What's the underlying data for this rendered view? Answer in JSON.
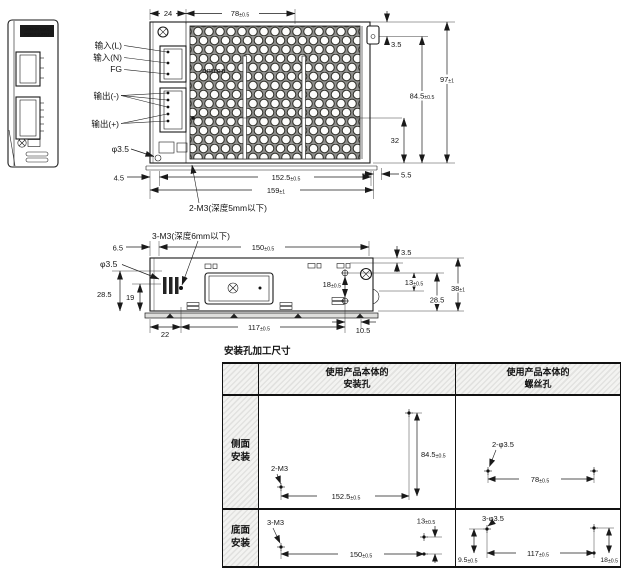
{
  "side_view": {
    "label_line1": "OMRON S8FS",
    "label_line2": "POWER SUPPLY"
  },
  "top_view": {
    "labels": {
      "input_l": "输入(L)",
      "input_n": "输入(N)",
      "fg": "FG",
      "output_minus": "输出(-)",
      "output_plus": "输出(+)",
      "emboss": "omron",
      "phi_hole": "φ3.5"
    },
    "callout_m3": "2-M3(深度5mm以下)",
    "dims": {
      "d24": {
        "v": "24",
        "tol": ""
      },
      "d78": {
        "v": "78",
        "tol": "±0.5"
      },
      "d35_top": {
        "v": "3.5",
        "tol": ""
      },
      "d97": {
        "v": "97",
        "tol": "±1"
      },
      "d845": {
        "v": "84.5",
        "tol": "±0.5"
      },
      "d32": {
        "v": "32",
        "tol": ""
      },
      "d45": {
        "v": "4.5",
        "tol": ""
      },
      "d1525": {
        "v": "152.5",
        "tol": "±0.5"
      },
      "d159": {
        "v": "159",
        "tol": "±1"
      },
      "d55": {
        "v": "5.5",
        "tol": ""
      }
    }
  },
  "bottom_view": {
    "callout_m3": "3-M3(深度6mm以下)",
    "labels": {
      "phi_hole": "φ3.5"
    },
    "dims": {
      "d65": {
        "v": "6.5",
        "tol": ""
      },
      "d150": {
        "v": "150",
        "tol": "±0.5"
      },
      "d35_right": {
        "v": "3.5",
        "tol": ""
      },
      "d13": {
        "v": "13",
        "tol": "±0.5"
      },
      "d38": {
        "v": "38",
        "tol": "±1"
      },
      "d285_right": {
        "v": "28.5",
        "tol": ""
      },
      "d18": {
        "v": "18",
        "tol": "±0.5"
      },
      "d285_left": {
        "v": "28.5",
        "tol": ""
      },
      "d19": {
        "v": "19",
        "tol": ""
      },
      "d22": {
        "v": "22",
        "tol": ""
      },
      "d117": {
        "v": "117",
        "tol": "±0.5"
      },
      "d105": {
        "v": "10.5",
        "tol": ""
      }
    }
  },
  "table": {
    "title": "安装孔加工尺寸",
    "col_mount": "使用产品本体的\n安装孔",
    "col_screw": "使用产品本体的\n螺丝孔",
    "row_side": "侧面\n安装",
    "row_bottom": "底面\n安装",
    "side_mount": {
      "label": "2-M3",
      "h": {
        "v": "152.5",
        "tol": "±0.5"
      },
      "vd": {
        "v": "84.5",
        "tol": "±0.5"
      }
    },
    "side_screw": {
      "label": "2-φ3.5",
      "h": {
        "v": "78",
        "tol": "±0.5"
      }
    },
    "bottom_mount": {
      "label": "3-M3",
      "h": {
        "v": "150",
        "tol": "±0.5"
      },
      "vd": {
        "v": "13",
        "tol": "±0.5"
      }
    },
    "bottom_screw": {
      "label": "3-φ3.5",
      "h": {
        "v": "117",
        "tol": "±0.5"
      },
      "left": {
        "v": "9.5",
        "tol": "±0.5"
      },
      "right": {
        "v": "18",
        "tol": "±0.5"
      }
    }
  }
}
